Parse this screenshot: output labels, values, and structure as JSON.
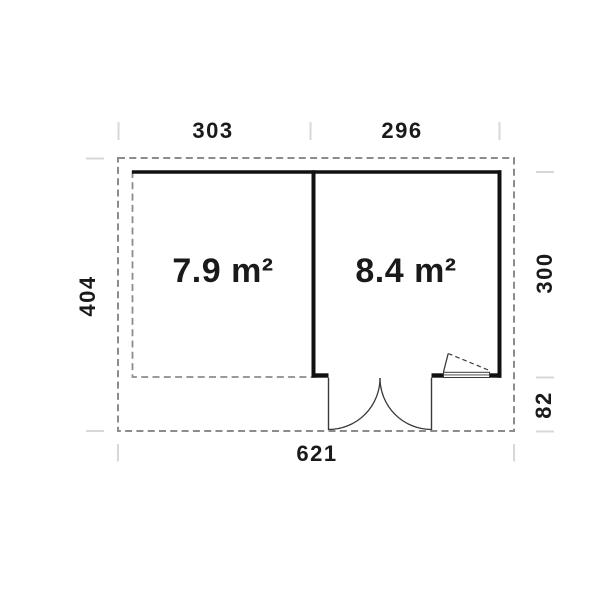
{
  "plan": {
    "rooms": [
      {
        "area_label": "7.9 m²"
      },
      {
        "area_label": "8.4 m²"
      }
    ],
    "dimensions": {
      "top_left_width": "303",
      "top_right_width": "296",
      "overall_width": "621",
      "overall_depth": "404",
      "right_room_depth": "300",
      "front_overhang_depth": "82"
    },
    "colors": {
      "wall": "#111111",
      "thin_line": "#3a3a3a",
      "dashed_outline": "#8c8c8c",
      "tick": "#d8d8d8",
      "text": "#1a1a1a",
      "background": "#ffffff"
    }
  }
}
